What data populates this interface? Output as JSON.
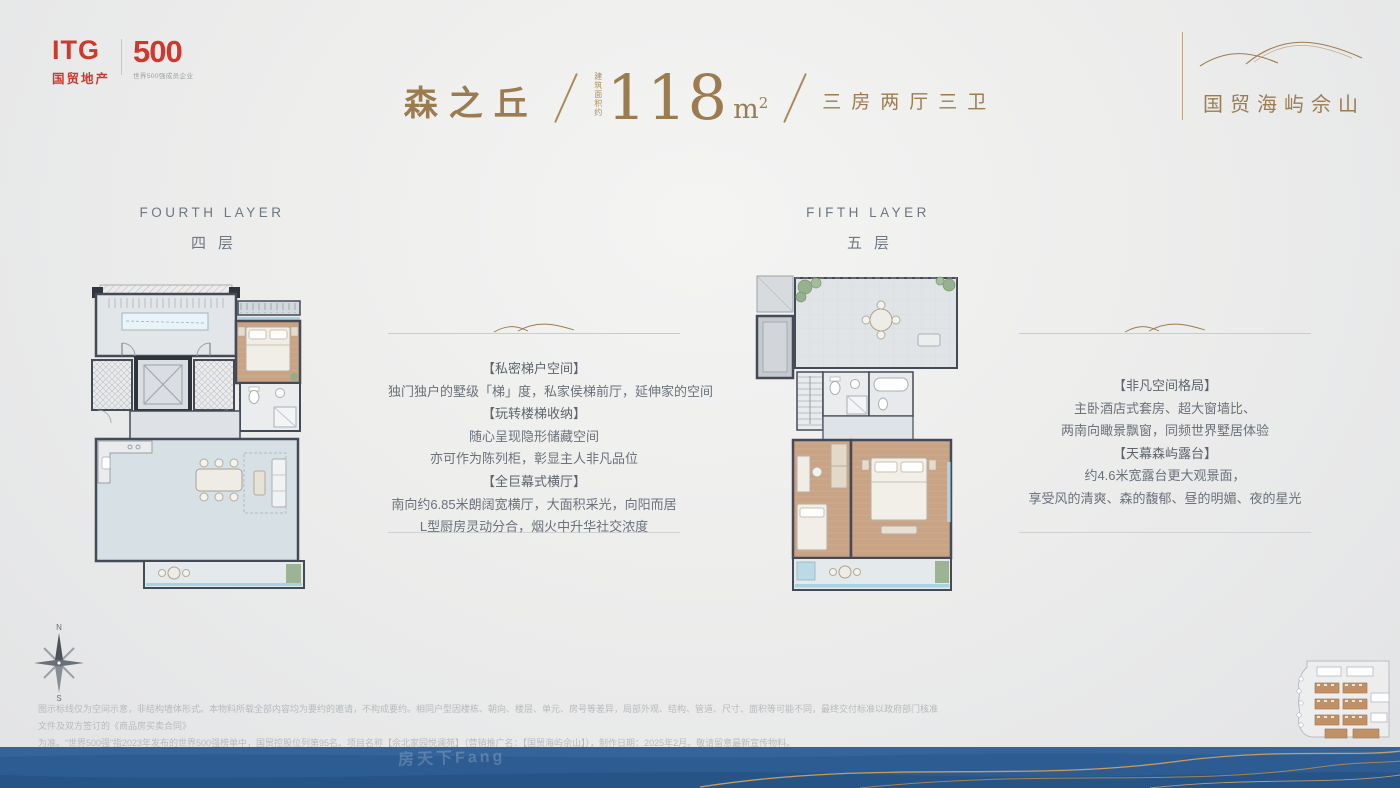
{
  "brand": {
    "itg_name": "ITG",
    "itg_sub": "国贸地产",
    "badge": "500",
    "badge_sub": "世界500强成员企业",
    "brand_red": "#cf382d"
  },
  "project": {
    "name": "国贸海屿佘山",
    "accent_gold": "#9b7c50"
  },
  "header": {
    "unit_name": "森之丘",
    "area_label": "建筑面积约",
    "area_value": "118",
    "area_unit": "m",
    "area_sup": "2",
    "rooms": "三房两厅三卫"
  },
  "floor_left": {
    "en": "FOURTH LAYER",
    "cn": "四层",
    "rows": [
      "【私密梯户空间】",
      "独门独户的墅级「梯」度，私家侯梯前厅，延伸家的空间",
      "【玩转楼梯收纳】",
      "随心呈现隐形储藏空间",
      "亦可作为陈列柜，彰显主人非凡品位",
      "【全巨幕式横厅】",
      "南向约6.85米朗阔宽横厅，大面积采光，向阳而居",
      "L型厨房灵动分合，烟火中升华社交浓度"
    ]
  },
  "floor_right": {
    "en": "FIFTH LAYER",
    "cn": "五层",
    "rows": [
      "【非凡空间格局】",
      "主卧酒店式套房、超大窗墙比、",
      "两南向瞰景飘窗，同频世界墅居体验",
      "【天幕森屿露台】",
      "约4.6米宽露台更大观景面，",
      "享受风的清爽、森的馥郁、昼的明媚、夜的星光"
    ]
  },
  "compass": {
    "n": "N",
    "s": "S"
  },
  "disclaimer": {
    "line1": "图示标线仅为空间示意，非结构墙体形式。本物料所载全部内容均为要约的邀请，不构成要约。相同户型因楼栋、朝向、楼层、单元、房号等差异，局部外观、结构、管道、尺寸、面积等可能不同，最终交付标准以政府部门核准文件及双方签订的《商品房买卖合同》",
    "line2": "为准。“世界500强”指2023年发布的世界500强榜单中，国贸控股位列第95名。项目名称【佘北家园悦澜苑】（营销推广名：【国贸海屿佘山】），制作日期：2025年2月。敬请留意最新宣传物料。"
  },
  "watermark": "房天下Fang",
  "footer": {
    "band_blue": "#2d5c92",
    "wave_gold": "#c79d5f"
  }
}
